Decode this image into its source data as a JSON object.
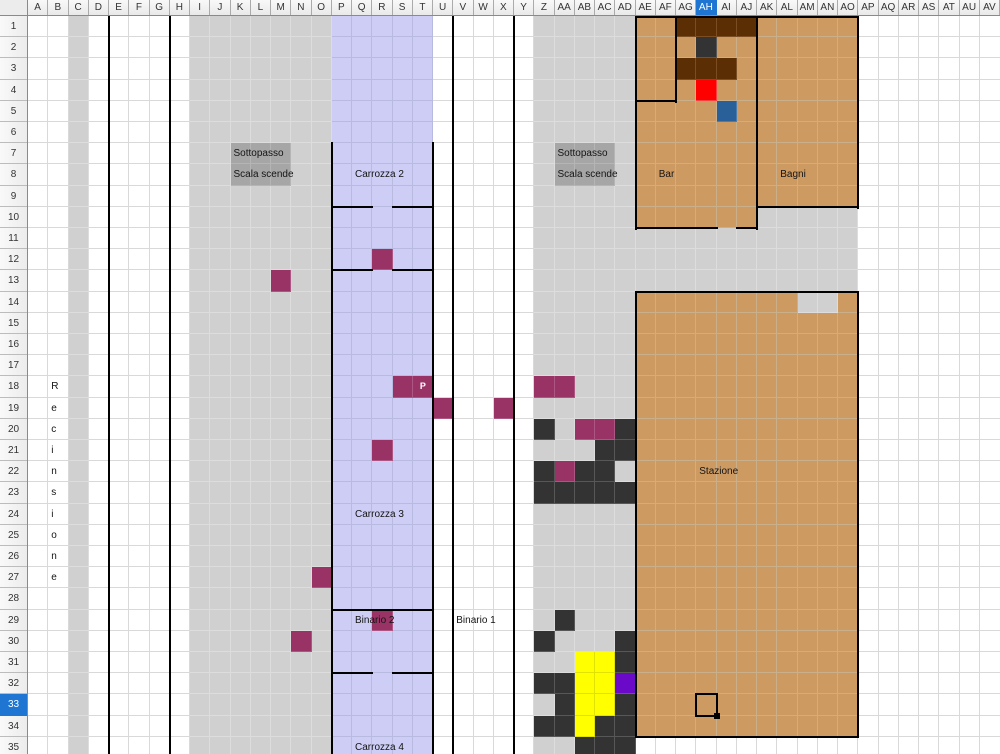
{
  "sheet": {
    "columns": [
      "A",
      "B",
      "C",
      "D",
      "E",
      "F",
      "G",
      "H",
      "I",
      "J",
      "K",
      "L",
      "M",
      "N",
      "O",
      "P",
      "Q",
      "R",
      "S",
      "T",
      "U",
      "V",
      "W",
      "X",
      "Y",
      "Z",
      "AA",
      "AB",
      "AC",
      "AD",
      "AE",
      "AF",
      "AG",
      "AH",
      "AI",
      "AJ",
      "AK",
      "AL",
      "AM",
      "AN",
      "AO",
      "AP",
      "AQ",
      "AR",
      "AS",
      "AT",
      "AU",
      "AV"
    ],
    "row_count": 35,
    "selected_column": "AH",
    "selected_row": 33,
    "cursor_cell": "AH33"
  },
  "palette": {
    "white_grid": "#d9d9d9",
    "wall": "#000000",
    "header_selected": "#1e76d2",
    "gray": {
      "fill": "#d0d0d0",
      "grid": "#dddddd"
    },
    "stairgray": {
      "fill": "#a6a6a6",
      "grid": "#b5b5b5"
    },
    "lavender": {
      "fill": "#cdcdf6",
      "grid": "#b9badf"
    },
    "tan": {
      "fill": "#cd9a62",
      "grid": "#c9b08a"
    },
    "maroon": {
      "fill": "#993366",
      "grid": "#ad5583"
    },
    "dark": {
      "fill": "#333333",
      "grid": "#575757"
    },
    "brown": {
      "fill": "#5c2e04",
      "grid": "#7a4e22"
    },
    "red": {
      "fill": "#ff0000",
      "grid": "#ff4040"
    },
    "blue": {
      "fill": "#2a6099",
      "grid": "#4a7cb0"
    },
    "yellow": {
      "fill": "#ffff00",
      "grid": "#e2e200"
    },
    "purple": {
      "fill": "#6a0ac8",
      "grid": "#8438d6"
    }
  },
  "regions": [
    {
      "name": "fence-strip-c",
      "cells": "C1:C35",
      "fill": "gray"
    },
    {
      "name": "platform-i-o",
      "cells": "I1:O35",
      "fill": "gray"
    },
    {
      "name": "platform-z-ad",
      "cells": "Z1:AD35",
      "fill": "gray"
    },
    {
      "name": "train-band",
      "cells": "P1:T35",
      "fill": "lavender"
    },
    {
      "name": "bar-building",
      "cells": "AE1:AJ10",
      "fill": "tan"
    },
    {
      "name": "bagni-building",
      "cells": "AK1:AO9",
      "fill": "tan"
    },
    {
      "name": "gray-below-bagni",
      "cells": "AK10:AO10",
      "fill": "gray"
    },
    {
      "name": "gray-mid-band",
      "cells": "AE11:AO13",
      "fill": "gray"
    },
    {
      "name": "stazione-building",
      "cells": "AE14:AO34",
      "fill": "tan"
    },
    {
      "name": "stazione-notch",
      "cells": "AM14:AN14",
      "fill": "gray"
    },
    {
      "name": "stairs-left",
      "cells": "K7:M8",
      "fill": "stairgray"
    },
    {
      "name": "stairs-right",
      "cells": "AA7:AC8",
      "fill": "stairgray"
    }
  ],
  "cells": {
    "brown": [
      "AG1",
      "AH1",
      "AI1",
      "AJ1",
      "AG3",
      "AH3",
      "AI3"
    ],
    "dark": [
      "AH2",
      "Z20",
      "AD20",
      "AC21",
      "AD21",
      "Z22",
      "AB22",
      "AC22",
      "Z23",
      "AA23",
      "AB23",
      "AC23",
      "AD23",
      "AA29",
      "Z30",
      "AD30",
      "AD31",
      "Z32",
      "AA32",
      "AA33",
      "AD33",
      "Z34",
      "AA34",
      "AC34",
      "AD34",
      "AB35",
      "AC35",
      "AD35"
    ],
    "maroon": [
      "R12",
      "M13",
      "S18",
      "T18",
      "Z18",
      "AA18",
      "U19",
      "X19",
      "AB20",
      "AC20",
      "R21",
      "AA22",
      "O27",
      "R29",
      "N30"
    ],
    "yellow": [
      "AB31",
      "AC31",
      "AB32",
      "AC32",
      "AB33",
      "AC33",
      "AB34"
    ],
    "red": [
      "AH4"
    ],
    "blue": [
      "AI5"
    ],
    "purple": [
      "AD32"
    ]
  },
  "lines": {
    "v": [
      {
        "col": "E",
        "from": 1,
        "to": 35
      },
      {
        "col": "H",
        "from": 1,
        "to": 35
      },
      {
        "col": "P",
        "from": 7,
        "to": 35
      },
      {
        "col": "U",
        "from": 7,
        "to": 35
      },
      {
        "col": "V",
        "from": 1,
        "to": 35
      },
      {
        "col": "Y",
        "from": 1,
        "to": 35
      },
      {
        "col": "AE",
        "from": 1,
        "to": 10
      },
      {
        "col": "AG",
        "from": 1,
        "to": 4
      },
      {
        "col": "AK",
        "from": 1,
        "to": 10
      },
      {
        "col": "AP",
        "from": 1,
        "to": 9
      },
      {
        "col": "AE",
        "from": 14,
        "to": 34
      },
      {
        "col": "AP",
        "from": 14,
        "to": 34
      }
    ],
    "h": [
      {
        "row": 1,
        "c1": "AE",
        "c2": "AO"
      },
      {
        "row": 5,
        "c1": "AE",
        "c2": "AF"
      },
      {
        "row": 10,
        "c1": "P",
        "c2": "Q"
      },
      {
        "row": 10,
        "c1": "S",
        "c2": "T"
      },
      {
        "row": 10,
        "c1": "AK",
        "c2": "AO"
      },
      {
        "row": 11,
        "c1": "AE",
        "c2": "AH"
      },
      {
        "row": 11,
        "c1": "AJ",
        "c2": "AJ"
      },
      {
        "row": 13,
        "c1": "P",
        "c2": "Q"
      },
      {
        "row": 13,
        "c1": "S",
        "c2": "T"
      },
      {
        "row": 14,
        "c1": "AE",
        "c2": "AO"
      },
      {
        "row": 29,
        "c1": "P",
        "c2": "T"
      },
      {
        "row": 32,
        "c1": "P",
        "c2": "Q"
      },
      {
        "row": 32,
        "c1": "S",
        "c2": "T"
      },
      {
        "row": 35,
        "c1": "AE",
        "c2": "AO"
      }
    ]
  },
  "labels": [
    {
      "name": "sottopasso-left",
      "text": "Sottopasso",
      "cell": "K7"
    },
    {
      "name": "scala-scende-left",
      "text": "Scala scende",
      "cell": "K8"
    },
    {
      "name": "sottopasso-right",
      "text": "Sottopasso",
      "cell": "AA7"
    },
    {
      "name": "scala-scende-right",
      "text": "Scala scende",
      "cell": "AA8"
    },
    {
      "name": "carrozza-2",
      "text": "Carrozza 2",
      "cell": "Q8"
    },
    {
      "name": "bar",
      "text": "Bar",
      "cell": "AF8"
    },
    {
      "name": "bagni",
      "text": "Bagni",
      "cell": "AL8"
    },
    {
      "name": "seat-p",
      "text": "P",
      "cell": "T18",
      "center": true,
      "bold": true,
      "small": true,
      "color": "#ffffff"
    },
    {
      "name": "stazione",
      "text": "Stazione",
      "cell": "AH22"
    },
    {
      "name": "carrozza-3",
      "text": "Carrozza 3",
      "cell": "Q24"
    },
    {
      "name": "binario-2",
      "text": "Binario 2",
      "cell": "Q29"
    },
    {
      "name": "binario-1",
      "text": "Binario 1",
      "cell": "V29"
    },
    {
      "name": "carrozza-4",
      "text": "Carrozza 4",
      "cell": "Q35"
    }
  ],
  "vertical_label": {
    "name": "recinsione",
    "text": "Recinsione",
    "column": "B",
    "start_row": 18
  }
}
